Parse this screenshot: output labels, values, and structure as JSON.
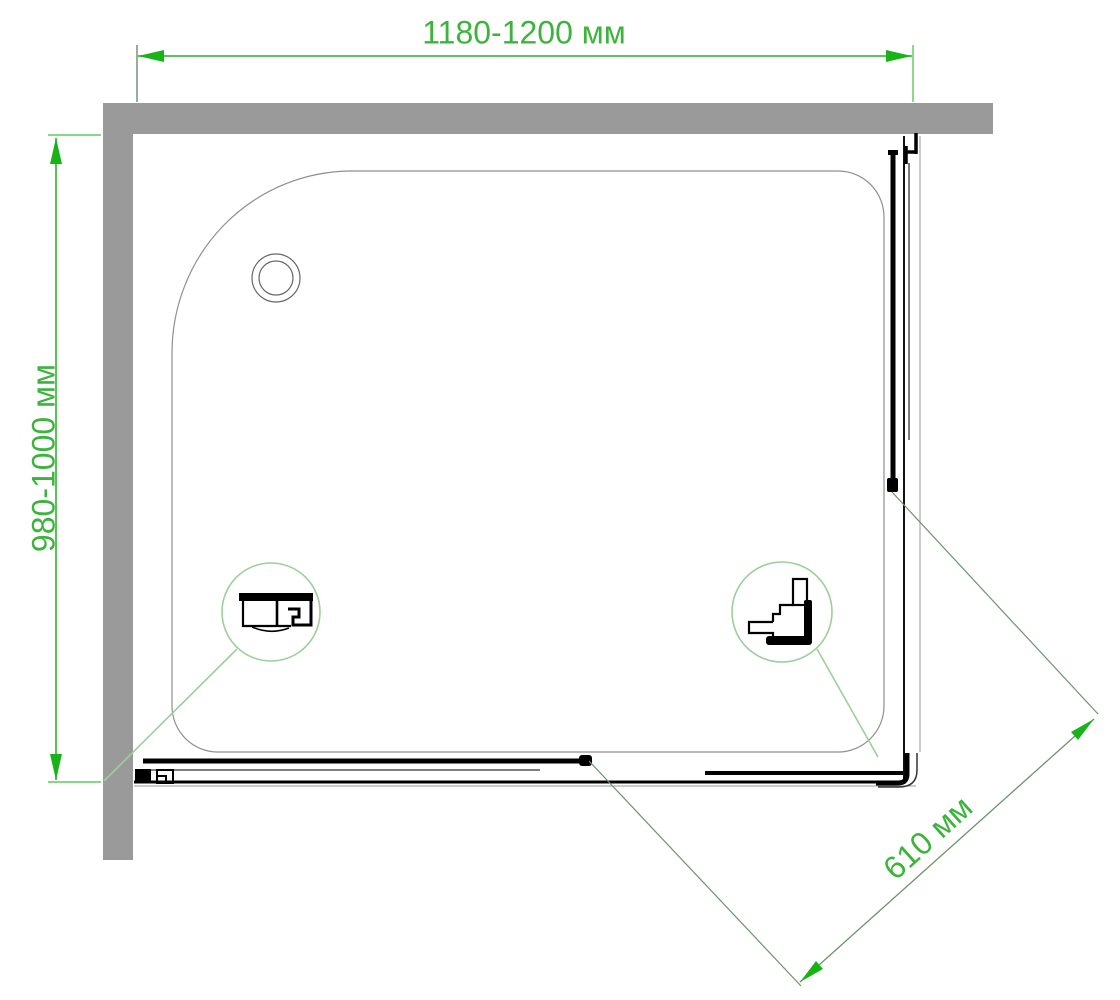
{
  "diagram": {
    "type": "technical-drawing",
    "subject": "shower-enclosure-top-view",
    "units": "мм",
    "labels": {
      "width": "1180-1200 мм",
      "depth": "980-1000 мм",
      "opening": "610 мм"
    },
    "values": {
      "width_range": [
        1180,
        1200
      ],
      "depth_range": [
        980,
        1000
      ],
      "opening": 610
    },
    "colors": {
      "background": "#ffffff",
      "wall-gray": "#9a9a9a",
      "tray-outline": "#8f8f8f",
      "drawing-black": "#111111",
      "dimension-line": "#3fbf3f",
      "arrow-green": "#17b317",
      "label-text": "#3cb43c",
      "callout-green": "#9bcf9b",
      "extension-line": "#6d936d"
    },
    "parts": {
      "wall": "wall",
      "tray": "shower-tray",
      "drain": "drain",
      "door_left": "sliding-door-bottom",
      "door_right": "sliding-door-right",
      "detail_left": "bottom-rail-profile-section",
      "detail_right": "corner-post-profile-section"
    }
  }
}
